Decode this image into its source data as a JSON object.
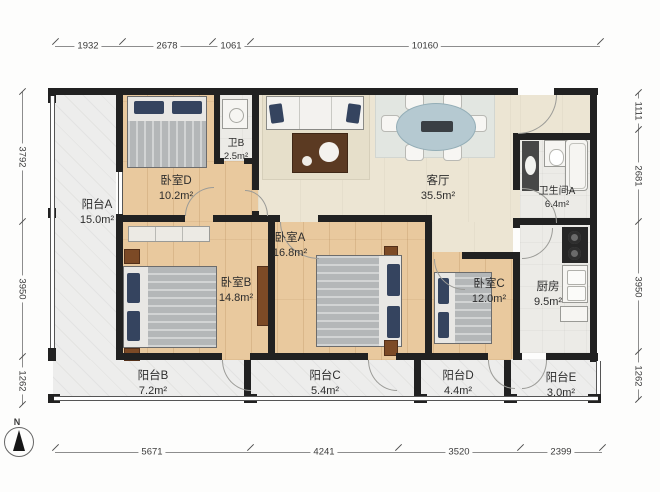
{
  "plan": {
    "compass_label": "N",
    "dimensions": {
      "top": [
        "1932",
        "2678",
        "1061",
        "10160"
      ],
      "bottom": [
        "5671",
        "4241",
        "3520",
        "2399"
      ],
      "left": [
        "3792",
        "3950",
        "1262"
      ],
      "right": [
        "1111",
        "2681",
        "3950",
        "1262"
      ]
    },
    "rooms": {
      "balcony_a": {
        "name": "阳台A",
        "area": "15.0m²"
      },
      "bedroom_d": {
        "name": "卧室D",
        "area": "10.2m²"
      },
      "bath_b": {
        "name": "卫B",
        "area": "2.5m²"
      },
      "living_room": {
        "name": "客厅",
        "area": "35.5m²"
      },
      "bathroom_a": {
        "name": "卫生间A",
        "area": "6.4m²"
      },
      "kitchen": {
        "name": "厨房",
        "area": "9.5m²"
      },
      "bedroom_b": {
        "name": "卧室B",
        "area": "14.8m²"
      },
      "bedroom_a": {
        "name": "卧室A",
        "area": "16.8m²"
      },
      "bedroom_c": {
        "name": "卧室C",
        "area": "12.0m²"
      },
      "balcony_b": {
        "name": "阳台B",
        "area": "7.2m²"
      },
      "balcony_c": {
        "name": "阳台C",
        "area": "5.4m²"
      },
      "balcony_d": {
        "name": "阳台D",
        "area": "4.4m²"
      },
      "balcony_e": {
        "name": "阳台E",
        "area": "3.0m²"
      }
    },
    "colors": {
      "wall": "#212121",
      "wood_floor": "#e9c99e",
      "living_floor": "#ece5d3",
      "pillow_accent": "#35445f"
    }
  }
}
